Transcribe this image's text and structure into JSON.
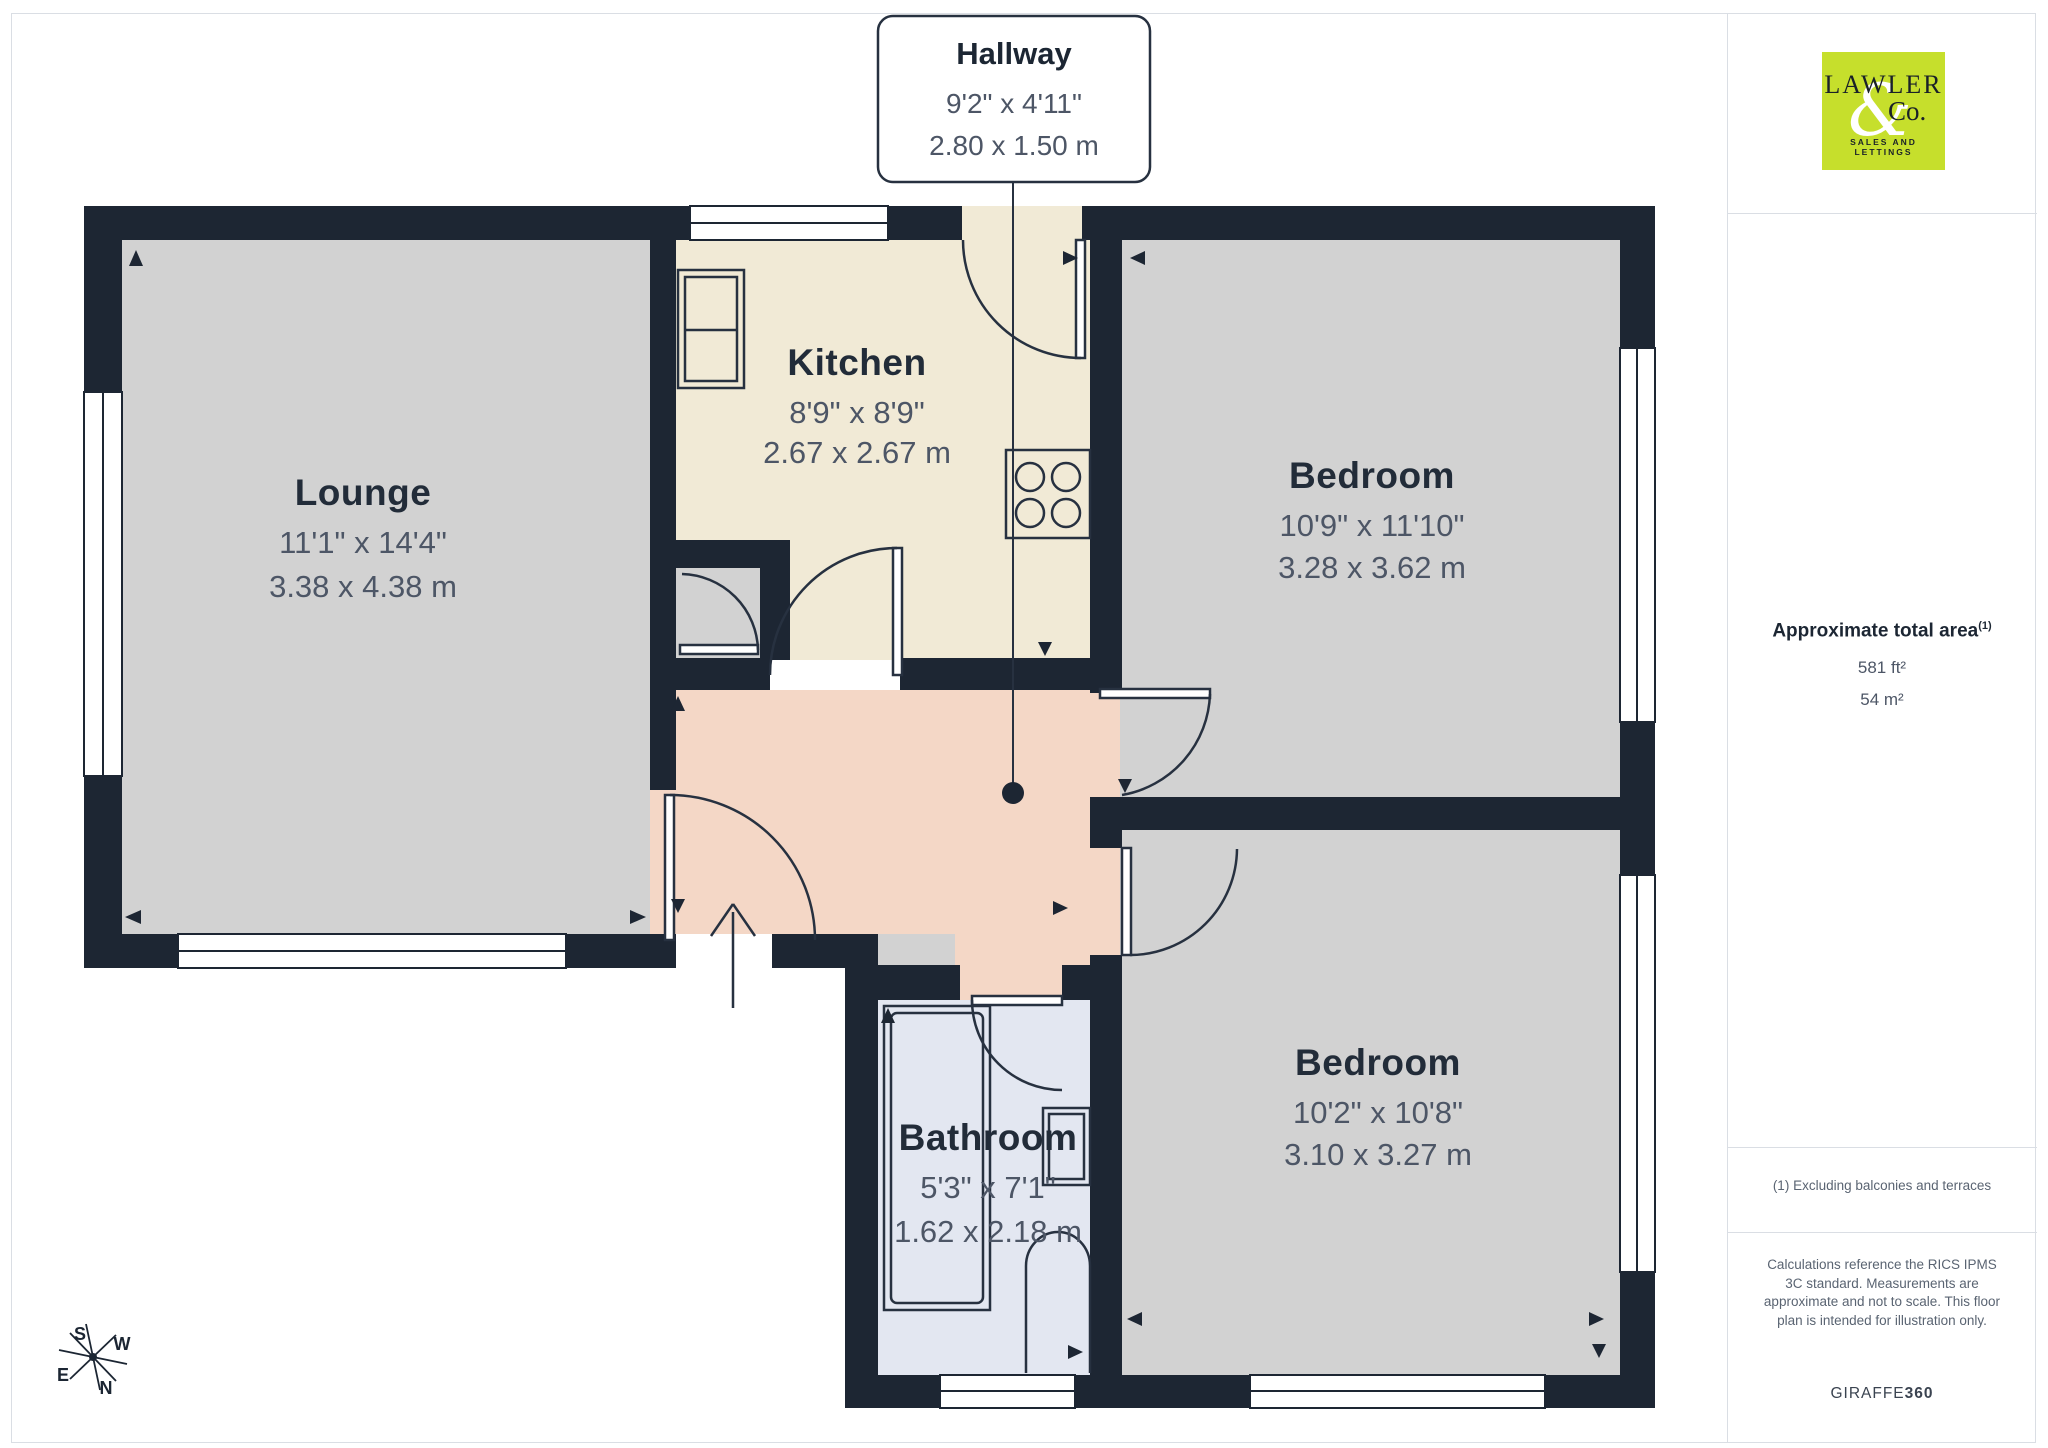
{
  "callout": {
    "room": "Hallway",
    "imperial": "9'2\" x 4'11\"",
    "metric": "2.80 x 1.50 m"
  },
  "rooms": [
    {
      "name": "Lounge",
      "imperial": "11'1\" x 14'4\"",
      "metric": "3.38 x 4.38 m"
    },
    {
      "name": "Kitchen",
      "imperial": "8'9\" x 8'9\"",
      "metric": "2.67 x 2.67 m"
    },
    {
      "name": "Bedroom",
      "imperial": "10'9\" x 11'10\"",
      "metric": "3.28 x 3.62 m"
    },
    {
      "name": "Bedroom",
      "imperial": "10'2\" x 10'8\"",
      "metric": "3.10 x 3.27 m"
    },
    {
      "name": "Bathroom",
      "imperial": "5'3\" x 7'1\"",
      "metric": "1.62 x 2.18 m"
    }
  ],
  "compass": {
    "n": "N",
    "s": "S",
    "e": "E",
    "w": "W"
  },
  "sidebar": {
    "logo": {
      "line1": "LAWLER",
      "amp": "&",
      "line2": "Co.",
      "tagline": "SALES AND LETTINGS",
      "background": "#c6df2c"
    },
    "area": {
      "title": "Approximate total area",
      "superscript": "(1)",
      "imperial": "581 ft²",
      "metric": "54 m²"
    },
    "footnote": "(1) Excluding balconies and terraces",
    "disclaimer": "Calculations reference the RICS IPMS 3C standard. Measurements are approximate and not to scale. This floor plan is intended for illustration only.",
    "brand": {
      "name": "GIRAFFE",
      "suffix": "360"
    }
  },
  "colors": {
    "wall": "#1d2633",
    "room_gray": "#d2d2d2",
    "kitchen_cream": "#f1ead6",
    "hallway_salmon": "#f4d7c6",
    "bathroom_blue": "#e3e7f1",
    "label_dark": "#222c39",
    "label_gray": "#4d5666"
  }
}
